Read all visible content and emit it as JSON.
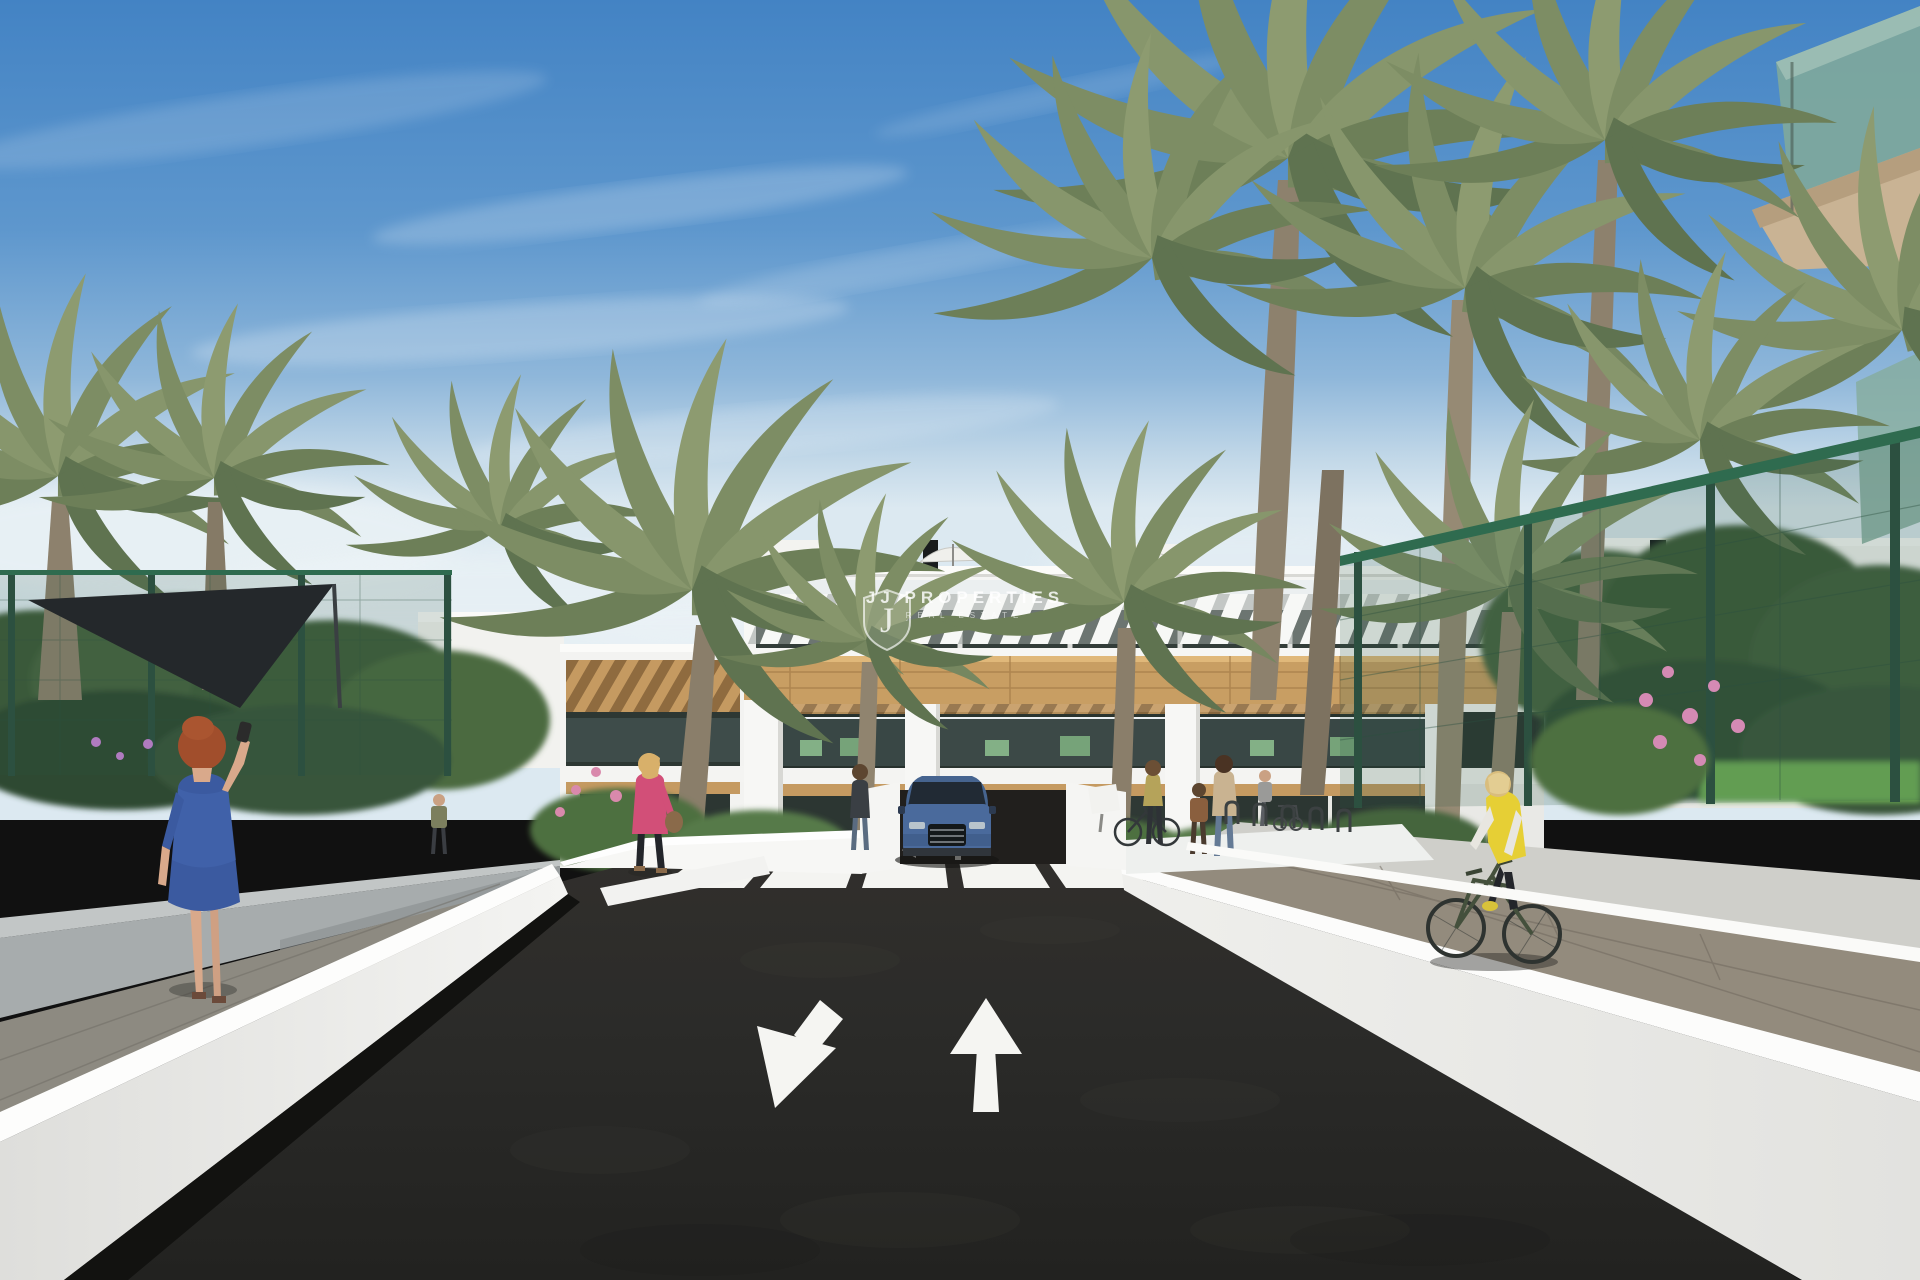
{
  "scene": {
    "kind": "architectural-3d-render",
    "watermark": {
      "line1": "JJ PROPERTIES",
      "line2": "REAL ESTATE",
      "logo_letter": "J"
    },
    "road_markings": {
      "arrow_left_lane": "arrow-down-left-icon",
      "arrow_right_lane": "arrow-up-icon",
      "crosswalk_stripes": 6
    },
    "palette": {
      "sky_top": "#4685c4",
      "sky_horizon": "#dce9f1",
      "building_white": "#f5f5f3",
      "wood_band": "#c89e63",
      "glass_dark": "#2c3632",
      "balcony_glass_green": "#86ada0",
      "palm_green": "#7d8d64",
      "tree_green": "#46633f",
      "fence_green": "#2e5a44",
      "asphalt": "#2b2b29",
      "wall_white": "#ededeb",
      "paver_brown": "#92897a",
      "car_blue": "#4a6a9c",
      "vest_yellow": "#e6cf35",
      "jacket_pink": "#d24f78",
      "dress_blue": "#3b5aa0",
      "flower_orange": "#d97b2f",
      "flower_pink": "#d58ab4"
    }
  }
}
